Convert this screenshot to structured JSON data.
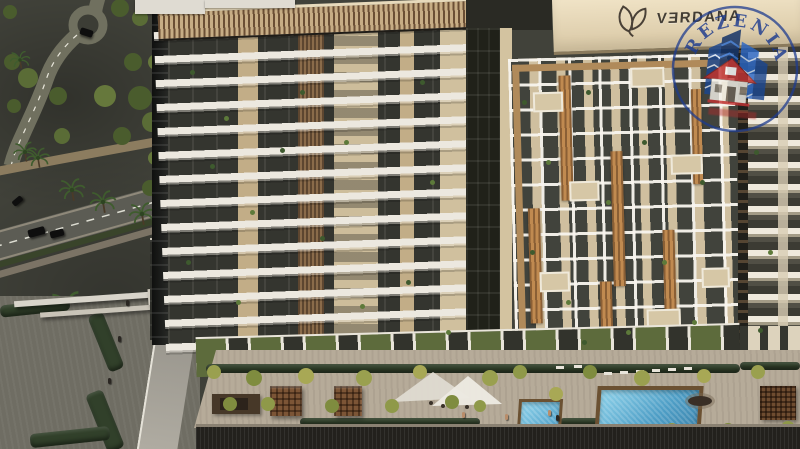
{
  "building_sign": {
    "text": "VERDANA",
    "stylized": "VƎRDANA"
  },
  "watermark": {
    "brand": "REZENIA"
  },
  "palette": {
    "groundDark": "#41423a",
    "roadGray": "#5c5c54",
    "lawnGreen": "#5d6b3c",
    "hedgeGreen": "#31402a",
    "treeYellow": "#9aa04f",
    "deckPave": "#b6ab99",
    "podiumWall": "#23211d",
    "slabWhite": "#ece8df",
    "glassDark": "#34352f",
    "towerBeige": "#d6c7a6",
    "parapetBeige": "#e7dabc",
    "woodAccent": "#c08a50",
    "woodDark": "#6b4f35",
    "poolWater": "#4e9ec6",
    "poolBorder": "#6b5132",
    "signInk": "#433d34",
    "watermarkBlue": "#1d3b8f",
    "watermarkRed": "#c33434"
  }
}
